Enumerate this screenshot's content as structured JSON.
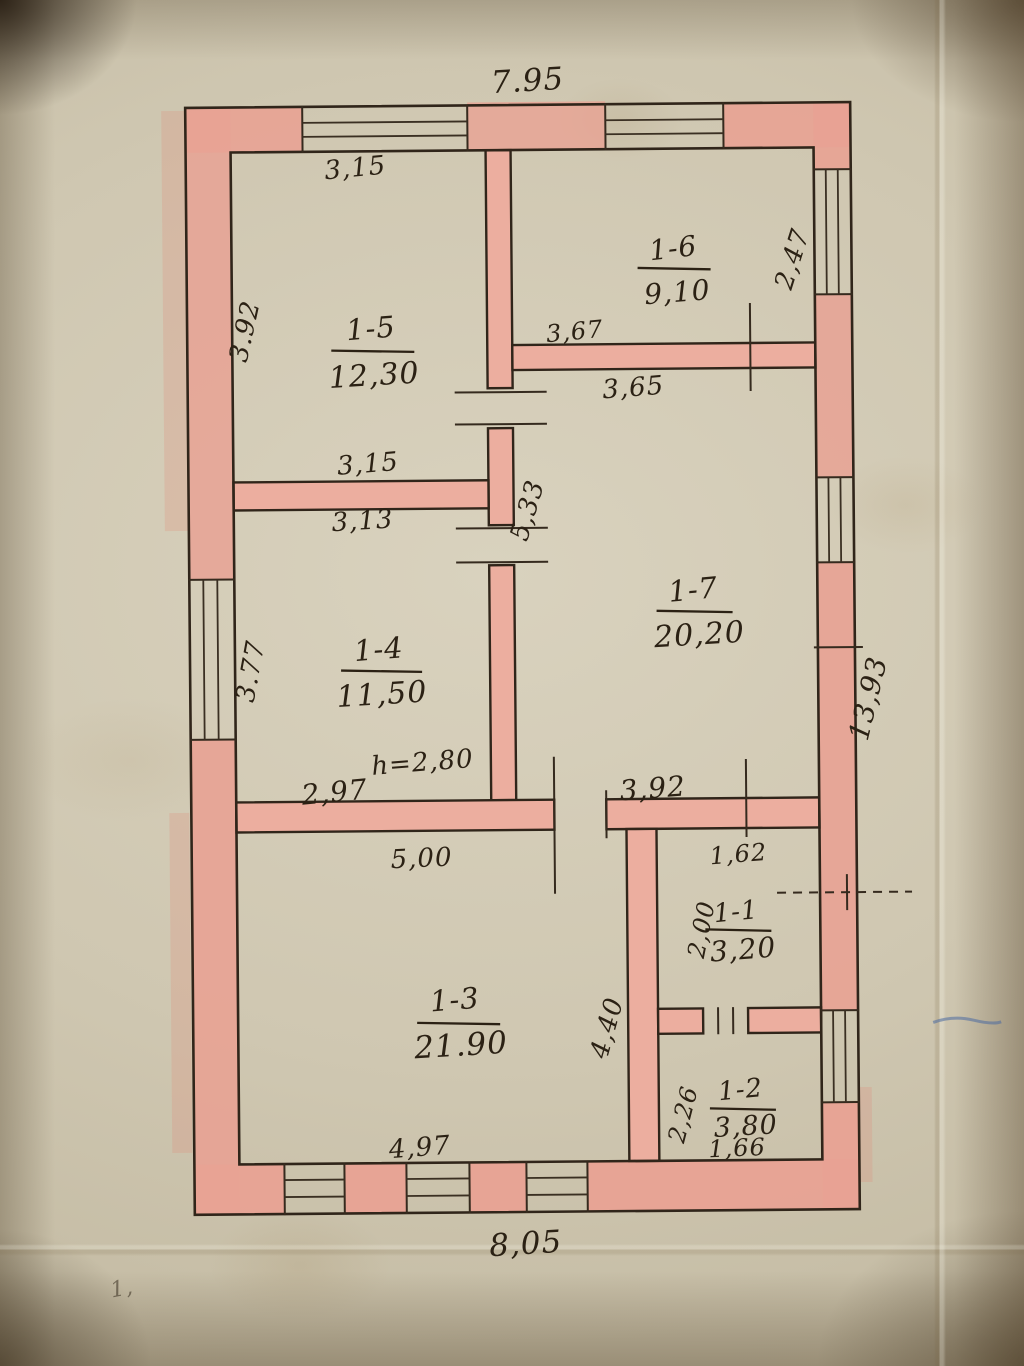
{
  "document": {
    "kind": "hand-drawn floor plan sheet"
  },
  "rooms": [
    {
      "id": "1-5",
      "area": "12,30"
    },
    {
      "id": "1-6",
      "area": "9,10"
    },
    {
      "id": "1-7",
      "area": "20,20"
    },
    {
      "id": "1-4",
      "area": "11,50"
    },
    {
      "id": "1-3",
      "area": "21.90"
    },
    {
      "id": "1-1",
      "area": "3,20"
    },
    {
      "id": "1-2",
      "area": "3,80"
    }
  ],
  "dims": {
    "overall_top": "7.95",
    "overall_bottom": "8,05",
    "overall_right": "13,93",
    "r15_top": "3,15",
    "r15_left": "3.92",
    "r15_bottom": "3,15",
    "r14_top": "3,13",
    "r14_left": "3.77",
    "r16_right": "2,47",
    "partition_16_17_top": "3,67",
    "partition_16_17_bottom": "3,65",
    "hall_vertical": "5,33",
    "corridor_left": "2,97",
    "corridor_right": "3,92",
    "r13_top": "5,00",
    "r13_bottom": "4,97",
    "r11_top": "1,62",
    "r11_left": "2,00",
    "partition_13_right": "4,40",
    "r12_left": "2,26",
    "r12_bottom": "1,66"
  },
  "note": {
    "ceiling_height": "h=2,80"
  },
  "marks": {
    "corner_note": "1,"
  },
  "colors": {
    "wall_fill": "#e8a294",
    "ink": "#30251a",
    "paper": "#cfc7b1",
    "stray_blue": "#4a6aa0"
  }
}
